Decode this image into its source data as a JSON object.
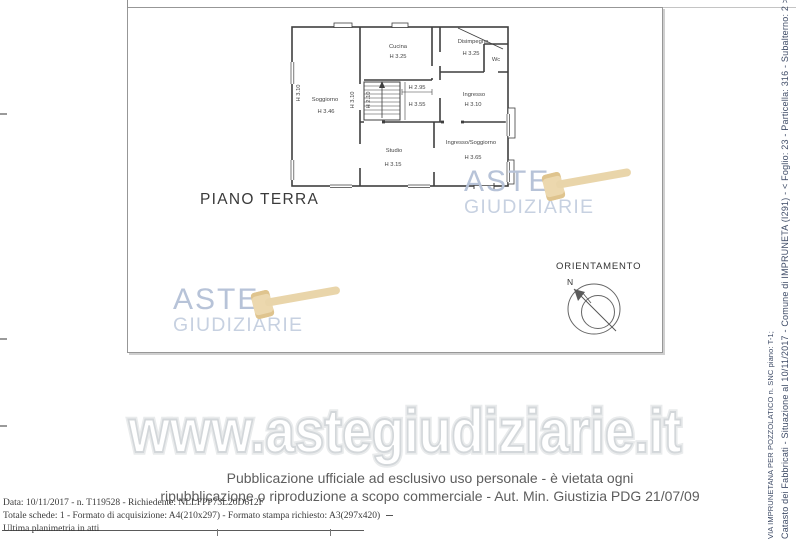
{
  "plan": {
    "floor_label": "PIANO TERRA",
    "rooms": {
      "soggiorno": {
        "name": "Soggiorno",
        "height": "H 3.46"
      },
      "cucina": {
        "name": "Cucina",
        "height": "H 3.25"
      },
      "disimpegno": {
        "name": "Disimpegno",
        "height": "H 3.25"
      },
      "wc": {
        "name": "Wc"
      },
      "ingresso": {
        "name": "Ingresso",
        "height": "H 3.10"
      },
      "studio": {
        "name": "Studio",
        "height": "H 3.15"
      },
      "ingresso_soggiorno": {
        "name": "Ingresso/Soggiorno",
        "height": "H 3.65"
      }
    },
    "dims": {
      "left_wall": "H 3.10",
      "mid_wall": "H 3.10",
      "stair": "H 2.10",
      "landing_upper": "H 2.95",
      "landing_lower": "H 3.55"
    }
  },
  "orientation": {
    "label": "ORIENTAMENTO",
    "north": "N"
  },
  "watermark": {
    "brand_line1": "ASTE",
    "brand_line2": "GIUDIZIARIE",
    "url": "www.astegiudiziarie.it",
    "brand_color": "#b7c3d8",
    "brand_color_light": "#c7d1e1",
    "gavel_color": "#e9d5aa",
    "url_outline_color": "#d3d7da"
  },
  "footer": {
    "notice_line1": "Pubblicazione ufficiale ad esclusivo uso personale - è vietata ogni",
    "notice_line2": "ripubblicazione o riproduzione a scopo commerciale - Aut. Min. Giustizia PDG 21/07/09",
    "meta_line1": "Data: 10/11/2017 - n. T119528 - Richiedente: NLLFPP73L20D612F",
    "meta_line2": "Totale schede: 1 - Formato di acquisizione: A4(210x297)  - Formato stampa richiesto: A3(297x420)",
    "meta_line3": "Ultima planimetria in atti"
  },
  "sidebar": {
    "line_outer": "Catasto dei Fabbricati - Situazione al 10/11/2017 - Comune di IMPRUNETA (I291) - < Foglio: 23 - Particella: 316 - Subalterno: 2 >",
    "line_inner": "VIA IMPRUNETANA PER POZZOLATICO n. SNC piano: T-1;",
    "text_color": "#3e4b66"
  }
}
